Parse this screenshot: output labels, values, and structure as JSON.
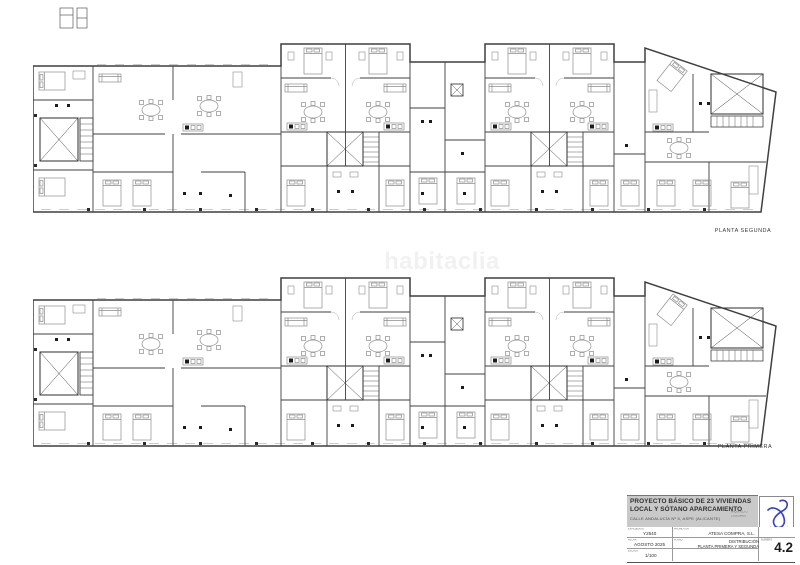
{
  "sheet": {
    "watermark": "habitaclia",
    "floor_labels": {
      "segunda": "PLANTA SEGUNDA",
      "primera": "PLANTA PRIMERA"
    }
  },
  "title_block": {
    "title_line1": "PROYECTO BÁSICO DE 23 VIVIENDAS",
    "title_line2": "LOCAL Y SÓTANO APARCAMIENTO",
    "address": "CALLE ANDALUCÍA Nº 5, ASPE (ALICANTE)",
    "architect_label": "ARQUITECTO",
    "architect_sub": "COLEGIADO",
    "fields": {
      "expediente_label": "EXPEDIENTE",
      "expediente_value": "Y2540",
      "promotor_label": "PROMOTOR",
      "promotor_value": "ATESA COMPRA, S.L.",
      "fecha_label": "FECHA",
      "fecha_value": "AGOSTO 2025",
      "plano_label": "PLANO",
      "plano_line1": "DISTRIBUCIÓN",
      "plano_line2": "PLANTA PRIMERA Y SEGUNDA",
      "escala_label": "ESCALA",
      "escala_value": "1/100",
      "numero_label": "NÚMERO",
      "numero_value": "4.2"
    },
    "colors": {
      "band_gray": "#c9c9c9",
      "logo_blue": "#3640c2",
      "wall_line": "#3f3f3f",
      "furniture_line": "#8d8d8d"
    }
  }
}
